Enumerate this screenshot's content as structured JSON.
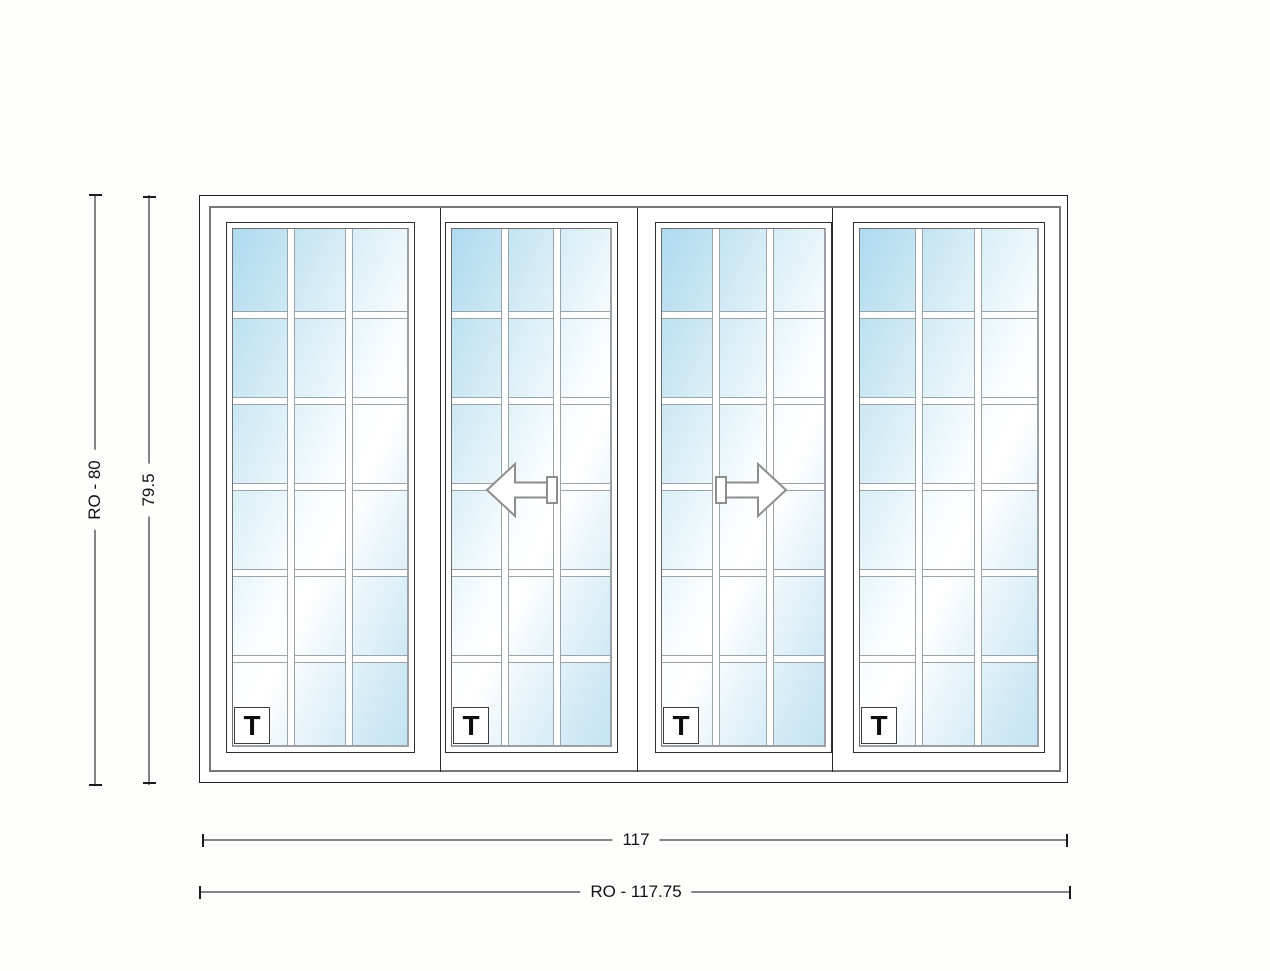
{
  "drawing": {
    "type": "sliding-door-elevation",
    "panel_count": 4,
    "grid": {
      "columns": 3,
      "rows": 6
    },
    "panels": [
      {
        "label": "T",
        "arrow": "none"
      },
      {
        "label": "T",
        "arrow": "left"
      },
      {
        "label": "T",
        "arrow": "right"
      },
      {
        "label": "T",
        "arrow": "none"
      }
    ],
    "dimensions": {
      "height_ro": "RO - 80",
      "height_frame": "79.5",
      "width_frame": "117",
      "width_ro": "RO - 117.75"
    },
    "colors": {
      "glass_blue": "#aedaee",
      "frame_gray": "#767676",
      "dim_line_gray": "#848484",
      "outline_black": "#222222"
    }
  }
}
